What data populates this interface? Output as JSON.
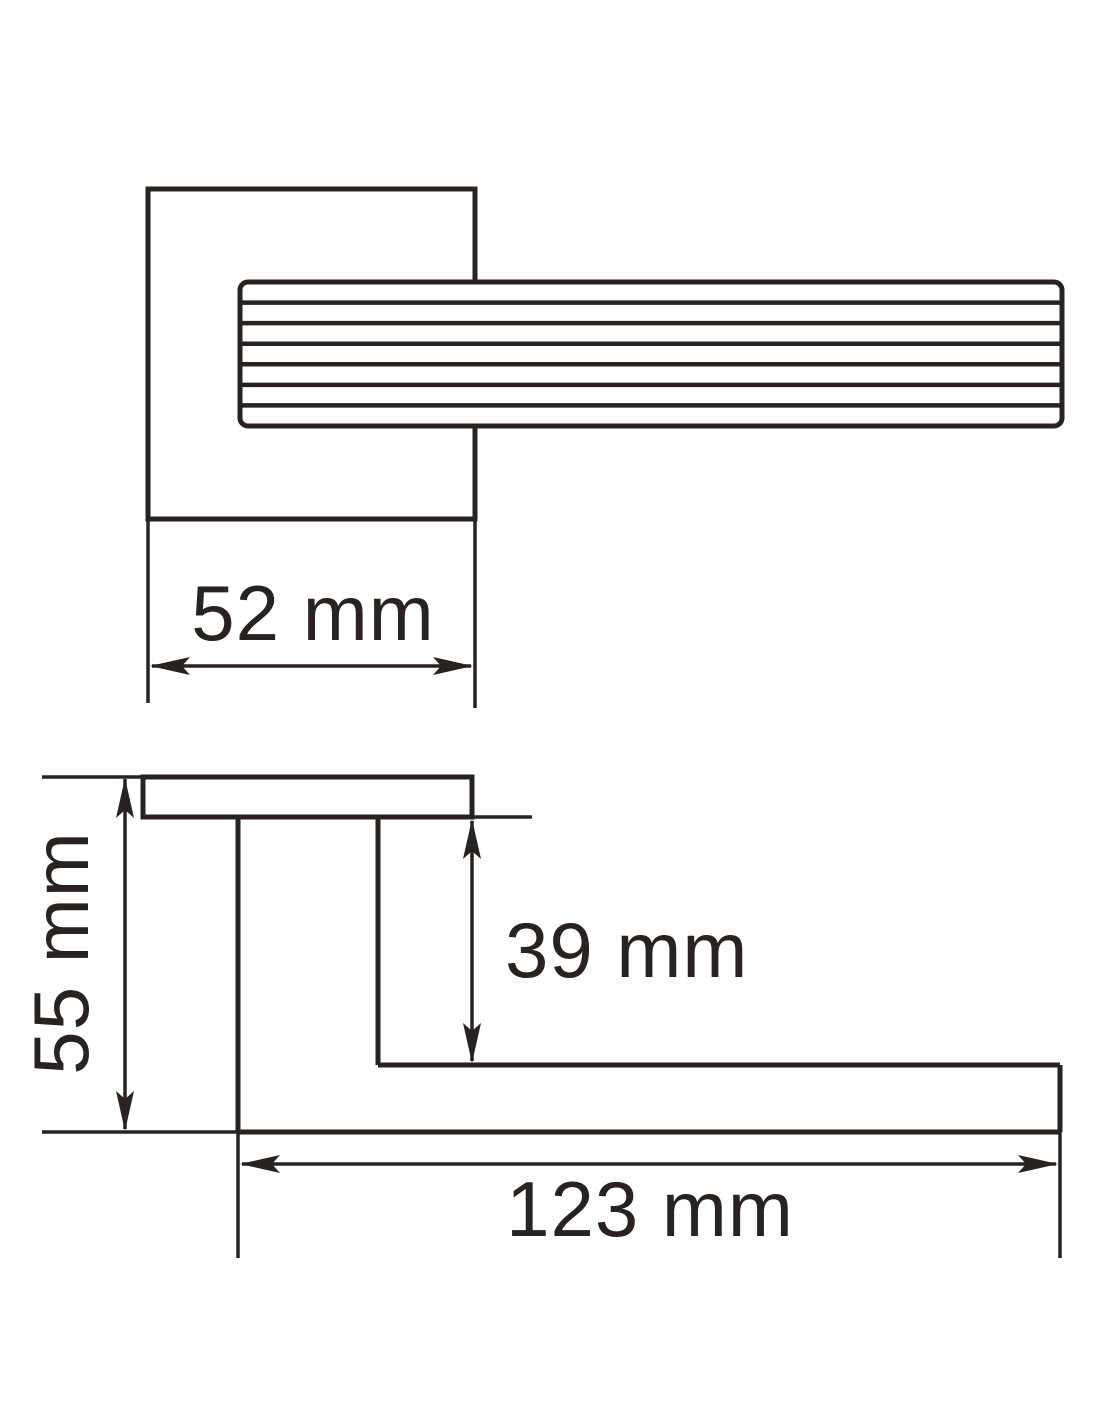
{
  "drawing": {
    "type": "technical-dimension-drawing",
    "subject": "door lever handle on square rose - front view and side profile view",
    "background_color": "#ffffff",
    "line_color": "#282220",
    "views": [
      {
        "id": "front-view",
        "description": "square rose plate with ribbed lever extending right"
      },
      {
        "id": "side-view",
        "description": "L-shaped side profile of plate, neck and lever arm"
      }
    ],
    "lever_grip_line_count": 6,
    "dimensions": [
      {
        "id": "rose_width",
        "label": "52 mm",
        "value_mm": 52,
        "measures": "width of square rose plate"
      },
      {
        "id": "overall_depth",
        "label": "55 mm",
        "value_mm": 55,
        "measures": "overall projection from plate top to lever underside"
      },
      {
        "id": "neck_drop",
        "label": "39 mm",
        "value_mm": 39,
        "measures": "distance from plate underside to lever arm top"
      },
      {
        "id": "lever_length",
        "label": "123 mm",
        "value_mm": 123,
        "measures": "length of lever arm from neck to tip"
      }
    ]
  }
}
